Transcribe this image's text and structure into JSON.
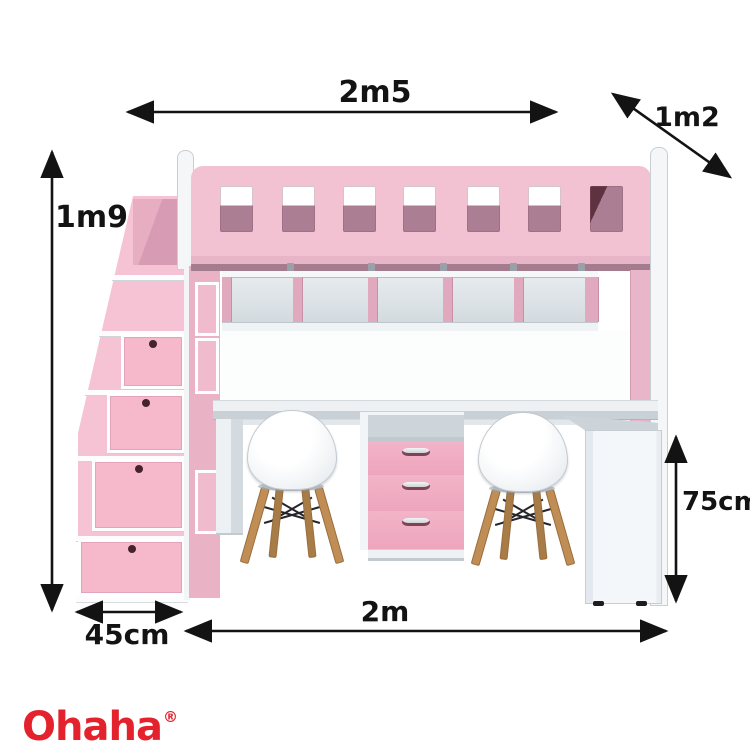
{
  "page": {
    "background": "#ffffff",
    "description": "Pink loft bed with staircase drawers, under-bed shelves, double desk, 3-drawer pedestal and two chairs, annotated with measurements"
  },
  "dimensions": {
    "overall_width": "2m5",
    "overall_depth": "1m2",
    "overall_height": "1m9",
    "desk_height": "75cm",
    "stair_width": "45cm",
    "desk_width": "2m"
  },
  "brand": {
    "name": "Ohaha",
    "registered_mark": "®",
    "color": "#e4222d"
  },
  "colors": {
    "pink_main": "#f2c2d3",
    "pink_drawer": "#f0abc2",
    "mauve_shadow": "#aa7e93",
    "white_frame": "#f4f6f8",
    "wood_leg": "#c08d55",
    "dimension_line": "#131313"
  }
}
